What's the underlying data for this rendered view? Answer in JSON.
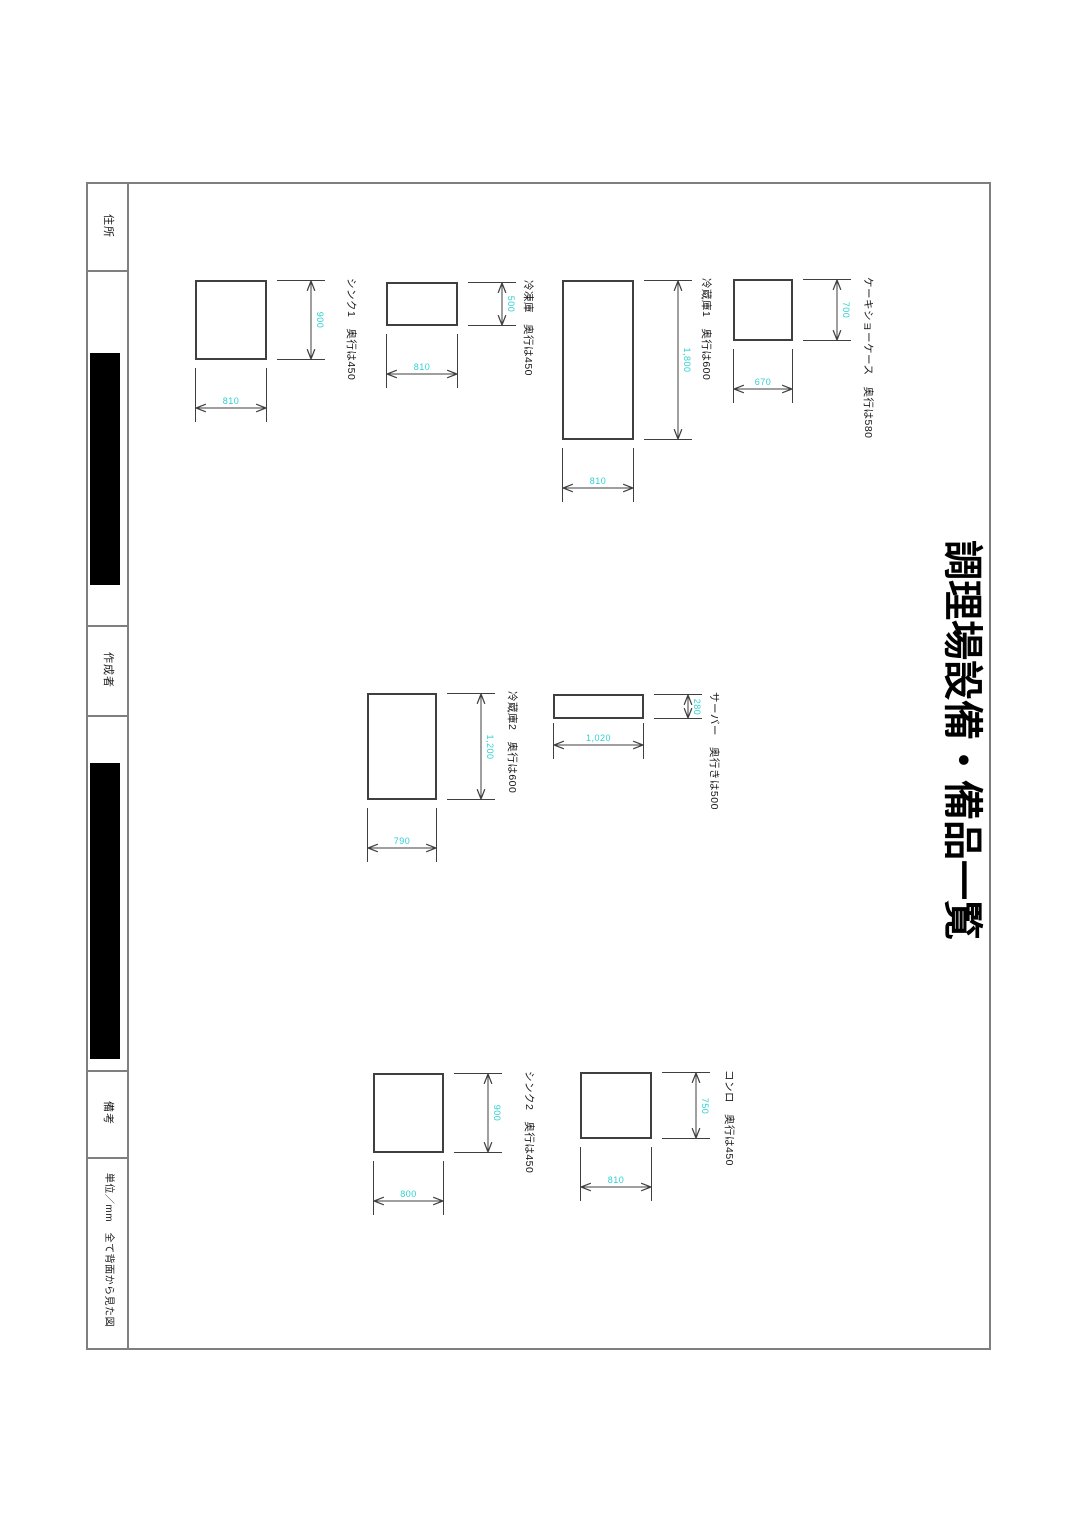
{
  "page": {
    "title": "調理場設備・備品一覧",
    "info_labels": {
      "address": "住所",
      "author": "作成者",
      "remarks": "備考",
      "unit_note": "単位／mm　全て背面から見た図"
    }
  },
  "items": [
    {
      "name": "シンク1",
      "depth_note": "奥行は450",
      "width_mm": "810",
      "height_mm": "900"
    },
    {
      "name": "冷凍庫",
      "depth_note": "奥行は450",
      "width_mm": "810",
      "height_mm": "500"
    },
    {
      "name": "冷蔵庫1",
      "depth_note": "奥行は600",
      "width_mm": "810",
      "height_mm": "1,800"
    },
    {
      "name": "ケーキショーケース",
      "depth_note": "奥行は580",
      "width_mm": "670",
      "height_mm": "700"
    },
    {
      "name": "冷蔵庫2",
      "depth_note": "奥行は600",
      "width_mm": "790",
      "height_mm": "1,200"
    },
    {
      "name": "サーバー",
      "depth_note": "奥行きは500",
      "width_mm": "1,020",
      "height_mm": "280"
    },
    {
      "name": "シンク2",
      "depth_note": "奥行は450",
      "width_mm": "800",
      "height_mm": "900"
    },
    {
      "name": "コンロ",
      "depth_note": "奥行は450",
      "width_mm": "810",
      "height_mm": "750"
    }
  ],
  "colors": {
    "dimension_text": "#2fd0d0",
    "drawing_line": "#3f3f3f",
    "frame_line": "#7f7f7f",
    "redaction": "#000000"
  }
}
